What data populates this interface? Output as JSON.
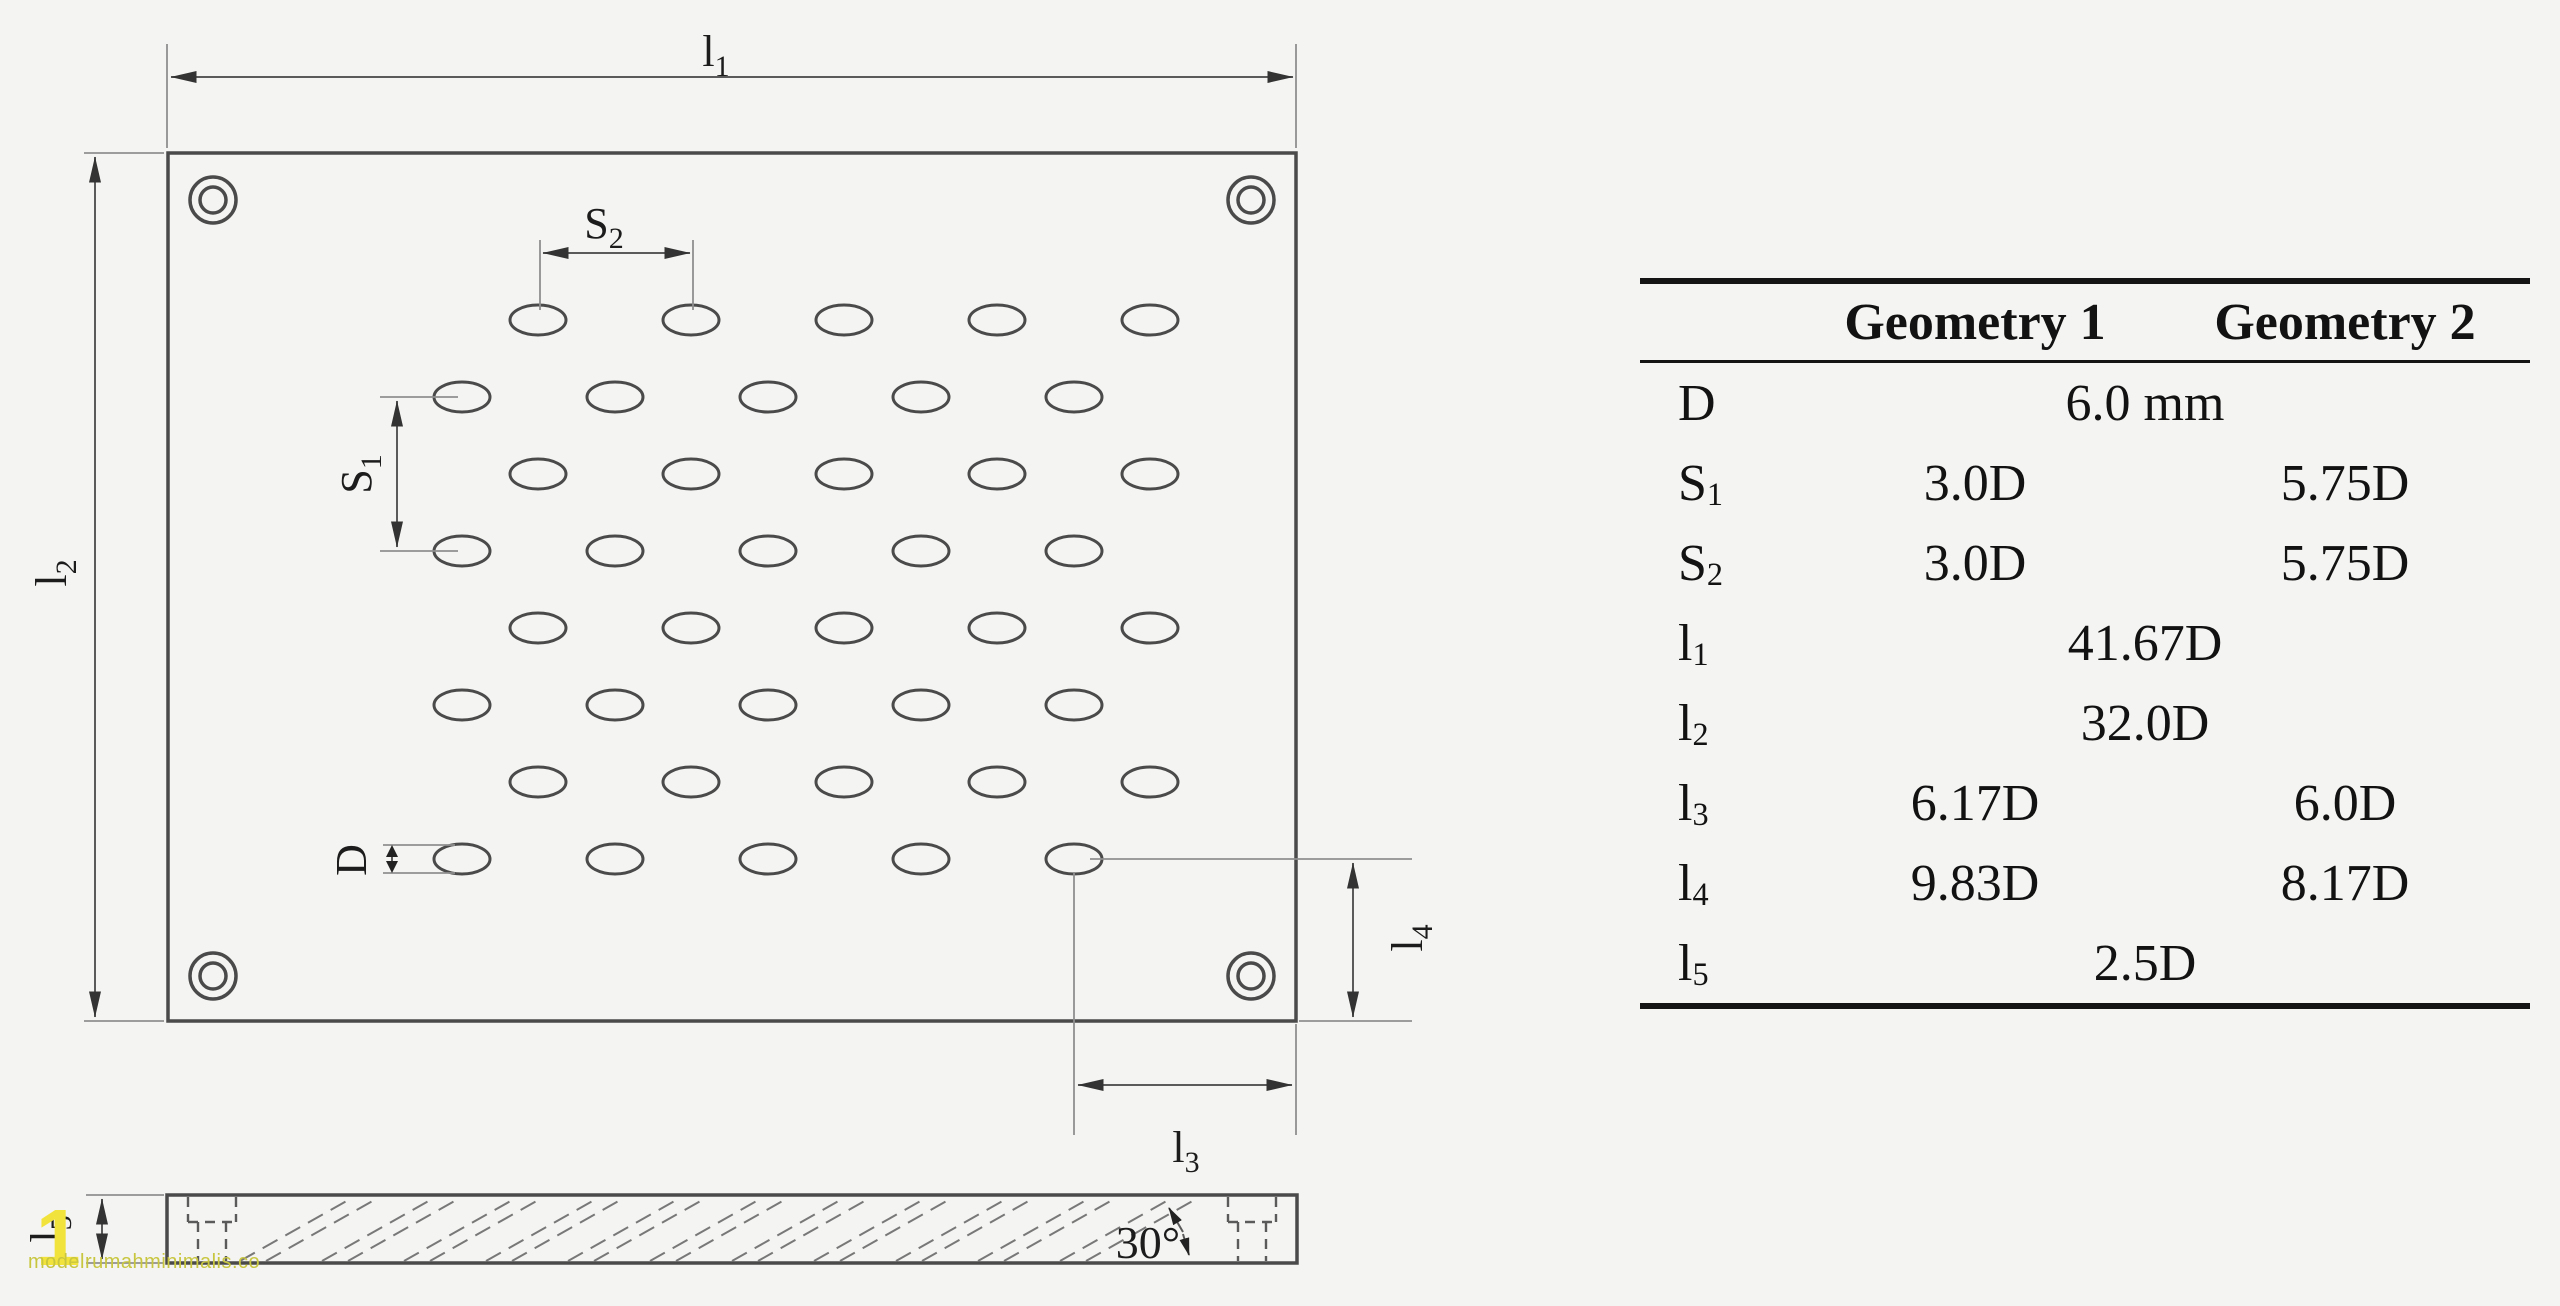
{
  "table": {
    "headers": {
      "geometry1": "Geometry 1",
      "geometry2": "Geometry 2"
    },
    "rows": [
      {
        "label": {
          "base": "D",
          "sub": ""
        },
        "span": "6.0 mm"
      },
      {
        "label": {
          "base": "S",
          "sub": "1"
        },
        "g1": "3.0D",
        "g2": "5.75D"
      },
      {
        "label": {
          "base": "S",
          "sub": "2"
        },
        "g1": "3.0D",
        "g2": "5.75D"
      },
      {
        "label": {
          "base": "l",
          "sub": "1"
        },
        "span": "41.67D"
      },
      {
        "label": {
          "base": "l",
          "sub": "2"
        },
        "span": "32.0D"
      },
      {
        "label": {
          "base": "l",
          "sub": "3"
        },
        "g1": "6.17D",
        "g2": "6.0D"
      },
      {
        "label": {
          "base": "l",
          "sub": "4"
        },
        "g1": "9.83D",
        "g2": "8.17D"
      },
      {
        "label": {
          "base": "l",
          "sub": "5"
        },
        "span": "2.5D"
      }
    ]
  },
  "diagram": {
    "labels": {
      "l1": {
        "base": "l",
        "sub": "1"
      },
      "l2": {
        "base": "l",
        "sub": "2"
      },
      "l3": {
        "base": "l",
        "sub": "3"
      },
      "l4": {
        "base": "l",
        "sub": "4"
      },
      "l5": {
        "base": "l",
        "sub": "5"
      },
      "s1": {
        "base": "S",
        "sub": "1"
      },
      "s2": {
        "base": "S",
        "sub": "2"
      },
      "d": {
        "base": "D",
        "sub": ""
      },
      "angle": "30°"
    },
    "holes": {
      "rows": 8,
      "cols": 5,
      "y0": 320,
      "row_pitch": 77,
      "x_odd_row": 538,
      "x_even_row": 462,
      "col_pitch": 153,
      "rx": 28,
      "ry": 15
    },
    "hatch": {
      "x_start": 240,
      "pairs": 11,
      "pair_step": 82,
      "pair_gap": 26,
      "run": 112,
      "y_top": 1198,
      "y_bottom": 1261
    }
  },
  "watermark": {
    "big": "1",
    "text": "modelrumahminimalis.co"
  },
  "colors": {
    "background": "#f4f4f2",
    "line": "#4a4a4a",
    "watermark_big": "#f2e33c",
    "watermark_text": "#c8c63f"
  }
}
